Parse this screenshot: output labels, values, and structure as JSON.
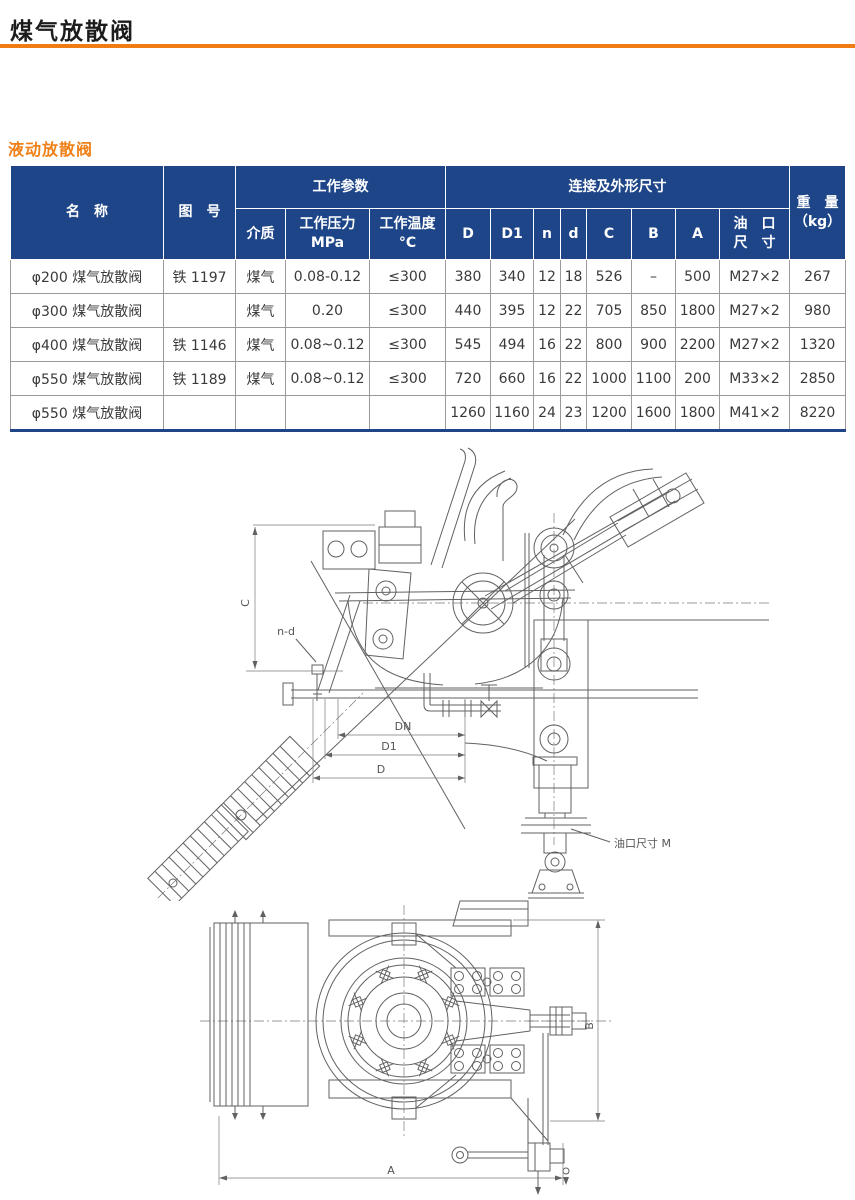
{
  "header": {
    "title": "煤气放散阀"
  },
  "section": {
    "title": "液动放散阀"
  },
  "colors": {
    "accent_orange": "#f07d13",
    "header_blue": "#1d4588",
    "body_text": "#3a3a3a"
  },
  "table": {
    "header": {
      "name": "名　称",
      "drawing_no": "图　号",
      "working_params": "工作参数",
      "medium": "介质",
      "pressure_line1": "工作压力",
      "pressure_line2": "MPa",
      "temperature_line1": "工作温度",
      "temperature_line2": "°C",
      "dims_group": "连接及外形尺寸",
      "col_D": "D",
      "col_D1": "D1",
      "col_n": "n",
      "col_d": "d",
      "col_C": "C",
      "col_B": "B",
      "col_A": "A",
      "oil_port_line1": "油　口",
      "oil_port_line2": "尺　寸",
      "weight_line1": "重　量",
      "weight_line2": "（kg）"
    },
    "rows": [
      [
        "φ200 煤气放散阀",
        "铁 1197",
        "煤气",
        "0.08-0.12",
        "≤300",
        "380",
        "340",
        "12",
        "18",
        "526",
        "–",
        "500",
        "M27×2",
        "267"
      ],
      [
        "φ300 煤气放散阀",
        "",
        "煤气",
        "0.20",
        "≤300",
        "440",
        "395",
        "12",
        "22",
        "705",
        "850",
        "1800",
        "M27×2",
        "980"
      ],
      [
        "φ400 煤气放散阀",
        "铁 1146",
        "煤气",
        "0.08~0.12",
        "≤300",
        "545",
        "494",
        "16",
        "22",
        "800",
        "900",
        "2200",
        "M27×2",
        "1320"
      ],
      [
        "φ550 煤气放散阀",
        "铁 1189",
        "煤气",
        "0.08~0.12",
        "≤300",
        "720",
        "660",
        "16",
        "22",
        "1000",
        "1100",
        "200",
        "M33×2",
        "2850"
      ],
      [
        "φ550 煤气放散阀",
        "",
        "",
        "",
        "",
        "1260",
        "1160",
        "24",
        "23",
        "1200",
        "1600",
        "1800",
        "M41×2",
        "8220"
      ]
    ]
  },
  "drawings": {
    "side_view": {
      "labels": {
        "c_dim": "C",
        "n_d": "n-d",
        "dn": "DN",
        "d1": "D1",
        "d": "D",
        "oil_port": "油口尺寸 M"
      }
    },
    "plan_view": {
      "labels": {
        "a_dim": "A",
        "b_dim": "B"
      }
    }
  }
}
